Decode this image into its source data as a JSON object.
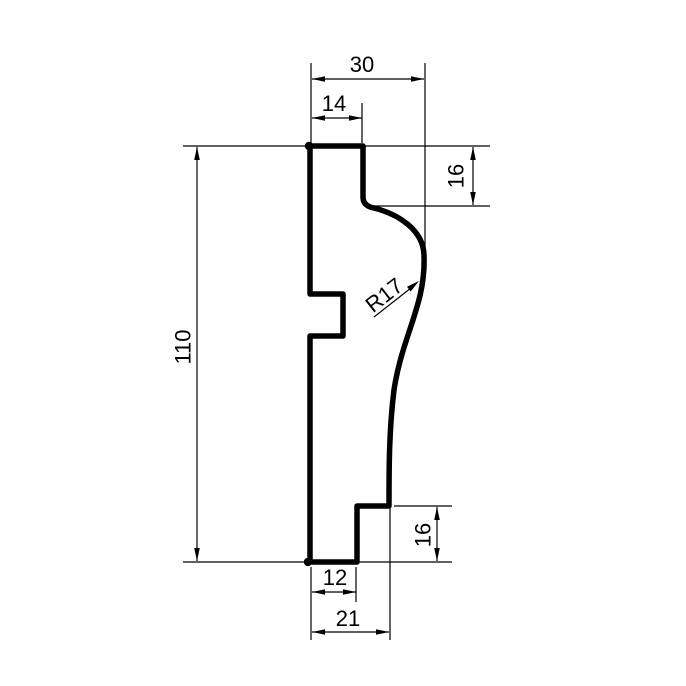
{
  "drawing": {
    "description": "Technical cross-section profile drawing with dimensions",
    "background_color": "#ffffff",
    "line_color": "#000000",
    "dims": {
      "overall_height": "110",
      "top_width": "30",
      "top_face_width": "14",
      "upper_right_height": "16",
      "radius_label": "R17",
      "lower_right_height": "16",
      "bottom_inner_width": "12",
      "bottom_width": "21"
    }
  }
}
